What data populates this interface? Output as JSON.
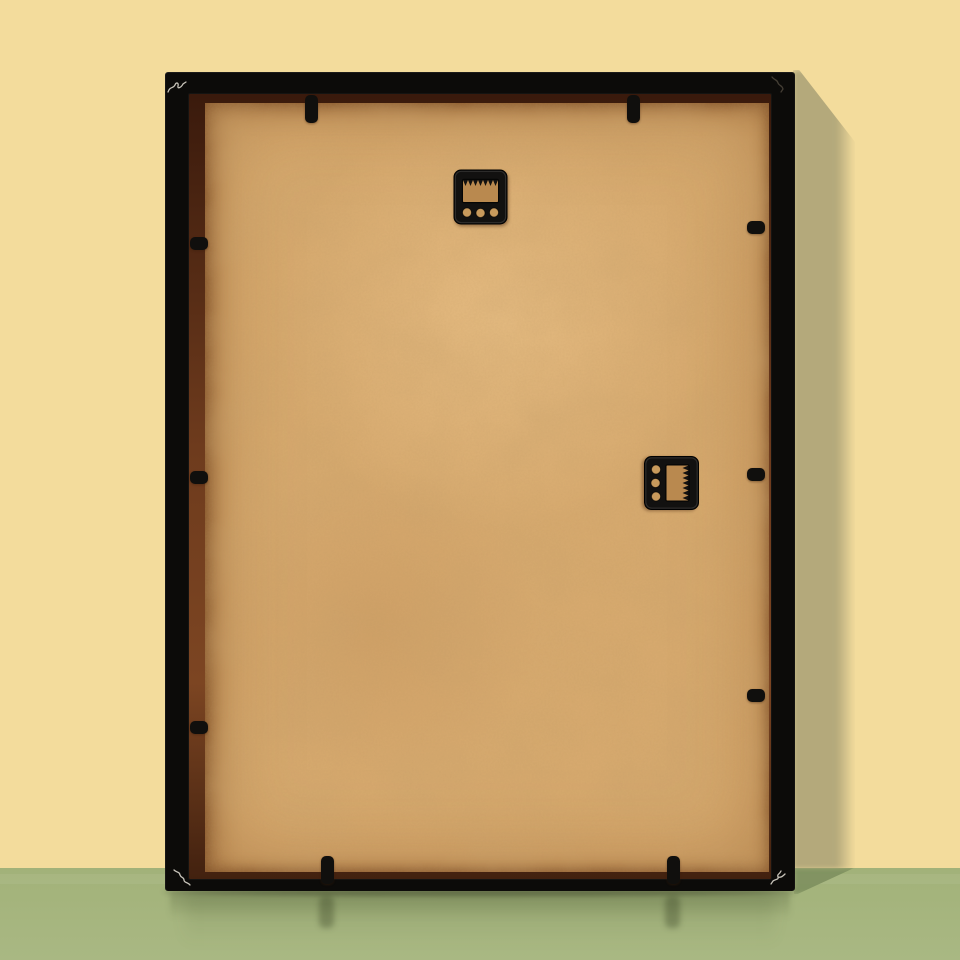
{
  "scene": {
    "subject": "back of a black picture frame leaning against a wall",
    "objects": [
      "picture-frame",
      "mdf-backing-board",
      "sawtooth-hangers",
      "retainer-tabs"
    ],
    "wall": "plain yellow wall",
    "surface": "green glossy floor"
  },
  "colors": {
    "wall": "#f3dc9c",
    "wall_shadow": "#b4a97b",
    "floor": "#a2b279",
    "floor_light": "#a9b883",
    "floor_shadow": "#7e905f",
    "frame_black": "#0c0b09",
    "hanger_black": "#100f0d",
    "board_base": "#d6a96e",
    "board_shadow": "#b9894f",
    "board_hole": "#c89a5c",
    "scratch": "#e9e4d8"
  },
  "geometry": {
    "canvas": {
      "width": 960,
      "height": 960
    },
    "floor_line_y": 868,
    "frame": {
      "left": 165,
      "top": 72,
      "width": 630,
      "height": 819
    }
  },
  "hardware": {
    "hangers": [
      {
        "name": "sawtooth-hanger-top",
        "orientation": "horizontal",
        "x": 453,
        "y": 169,
        "holes": 3,
        "teeth": 7
      },
      {
        "name": "sawtooth-hanger-side",
        "orientation": "vertical",
        "x": 644,
        "y": 455,
        "holes": 3,
        "teeth": 7
      }
    ],
    "tab_count": 10,
    "tabs": [
      {
        "side": "top",
        "x": 305,
        "y": 95,
        "w": 13,
        "h": 28
      },
      {
        "side": "top",
        "x": 627,
        "y": 95,
        "w": 13,
        "h": 28
      },
      {
        "side": "bottom",
        "x": 321,
        "y": 856,
        "w": 13,
        "h": 28
      },
      {
        "side": "bottom",
        "x": 667,
        "y": 856,
        "w": 13,
        "h": 28
      },
      {
        "side": "left",
        "x": 190,
        "y": 237,
        "w": 18,
        "h": 13
      },
      {
        "side": "left",
        "x": 190,
        "y": 471,
        "w": 18,
        "h": 13
      },
      {
        "side": "left",
        "x": 190,
        "y": 721,
        "w": 18,
        "h": 13
      },
      {
        "side": "right",
        "x": 747,
        "y": 221,
        "w": 18,
        "h": 13
      },
      {
        "side": "right",
        "x": 747,
        "y": 468,
        "w": 18,
        "h": 13
      },
      {
        "side": "right",
        "x": 747,
        "y": 689,
        "w": 18,
        "h": 13
      }
    ],
    "tab_reflections": [
      {
        "x": 319,
        "y": 896
      },
      {
        "x": 665,
        "y": 896
      }
    ]
  },
  "marks": {
    "corner_scratches": [
      {
        "corner": "top-left",
        "tone": "light"
      },
      {
        "corner": "top-right",
        "tone": "dark"
      },
      {
        "corner": "bottom-left",
        "tone": "light"
      },
      {
        "corner": "bottom-right",
        "tone": "light"
      }
    ]
  }
}
